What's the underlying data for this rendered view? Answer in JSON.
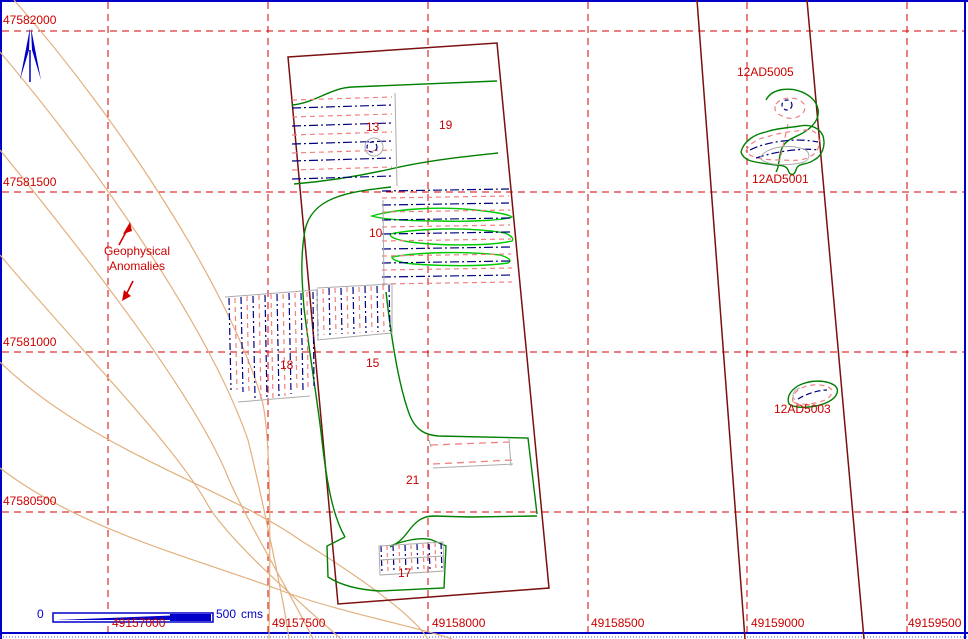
{
  "grid": {
    "x_labels": [
      "49157000",
      "49157500",
      "49158000",
      "49158500",
      "49159000",
      "49159500"
    ],
    "y_labels": [
      "47582000",
      "47581500",
      "47581000",
      "47580500"
    ]
  },
  "areas": [
    "13",
    "19",
    "10",
    "18",
    "15",
    "21",
    "17"
  ],
  "sites": [
    "12AD5005",
    "12AD5001",
    "12AD5003"
  ],
  "annotation": {
    "text": "Geophysical Anomalies"
  },
  "scale_bar": {
    "zero": "0",
    "max": "500",
    "unit": "cms"
  },
  "icons": {
    "north_arrow": "north-arrow"
  },
  "colors": {
    "grid_red": "#d40000",
    "label_red": "#cc0000",
    "contour_tan": "#e2b07e",
    "survey_maroon": "#7a1010",
    "green_dark": "#008000",
    "green_bright": "#00c800",
    "hatch_navy": "#000080",
    "hatch_pink": "#f08080",
    "blue": "#0000c8",
    "gray": "#ababab"
  }
}
